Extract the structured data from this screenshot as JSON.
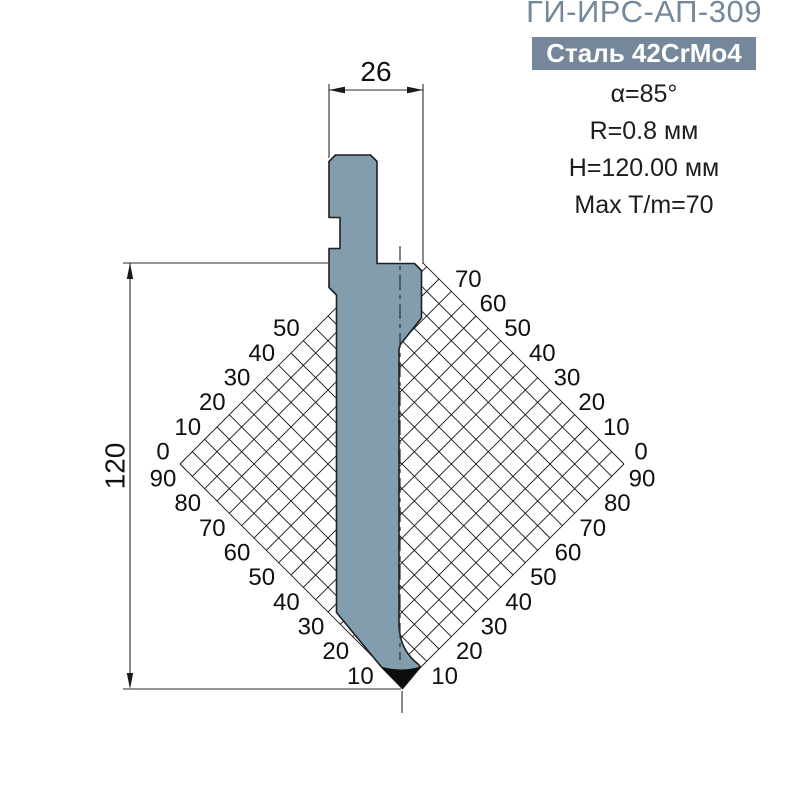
{
  "header": {
    "title": "ГИ-ИРС-АП-309",
    "material_badge": "Сталь 42CrMo4"
  },
  "specs": [
    "α=85°",
    "R=0.8 мм",
    "H=120.00 мм",
    "Max T/m=70"
  ],
  "drawing": {
    "width_dim": "26",
    "height_dim": "120",
    "gauge_scales": {
      "upper_left": [
        "0",
        "10",
        "20",
        "30",
        "40",
        "50"
      ],
      "lower_left": [
        "90",
        "80",
        "70",
        "60",
        "50",
        "40",
        "30",
        "20",
        "10"
      ],
      "upper_right": [
        "0",
        "10",
        "20",
        "30",
        "40",
        "50",
        "60",
        "70"
      ],
      "lower_right": [
        "90",
        "80",
        "70",
        "60",
        "50",
        "40",
        "30",
        "20",
        "10"
      ]
    }
  },
  "colors": {
    "accent": "#74879b",
    "badge_bg": "#75879a",
    "badge_text": "#ffffff",
    "punch_fill": "#819dae",
    "line": "#222222",
    "tip": "#0d0d0d"
  }
}
